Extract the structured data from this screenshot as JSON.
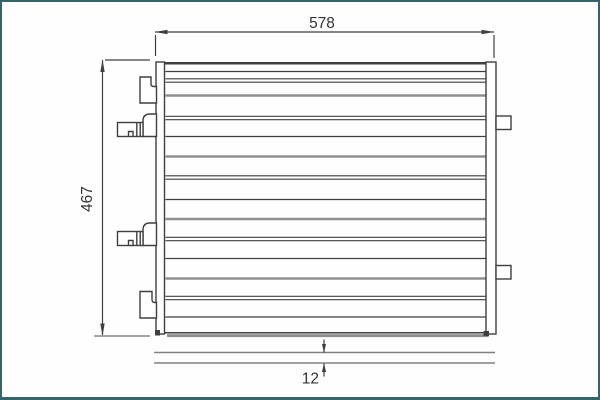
{
  "page": {
    "background": "#fdfefd",
    "border_color": "#35646b"
  },
  "drawing": {
    "description": "condenser-technical-drawing-front-view",
    "labels": {
      "width": "578",
      "height": "467",
      "thickness": "12"
    },
    "colors": {
      "line": "#3f3f3f",
      "gray": "#8f8f8f",
      "ext": "#6e6e6e",
      "text": "#333333"
    },
    "core_lines": [
      {
        "y": 69.5,
        "style": "thin"
      },
      {
        "y": 78.5,
        "style": "double"
      },
      {
        "y": 93.5,
        "style": "gray"
      },
      {
        "y": 116.0,
        "style": "double"
      },
      {
        "y": 134.5,
        "style": "thin"
      },
      {
        "y": 154.5,
        "style": "gray"
      },
      {
        "y": 175.5,
        "style": "double"
      },
      {
        "y": 197.5,
        "style": "thin"
      },
      {
        "y": 217.0,
        "style": "gray"
      },
      {
        "y": 237.0,
        "style": "double"
      },
      {
        "y": 256.5,
        "style": "thin"
      },
      {
        "y": 276.5,
        "style": "gray"
      },
      {
        "y": 296.0,
        "style": "double"
      },
      {
        "y": 315.0,
        "style": "thin"
      }
    ]
  }
}
